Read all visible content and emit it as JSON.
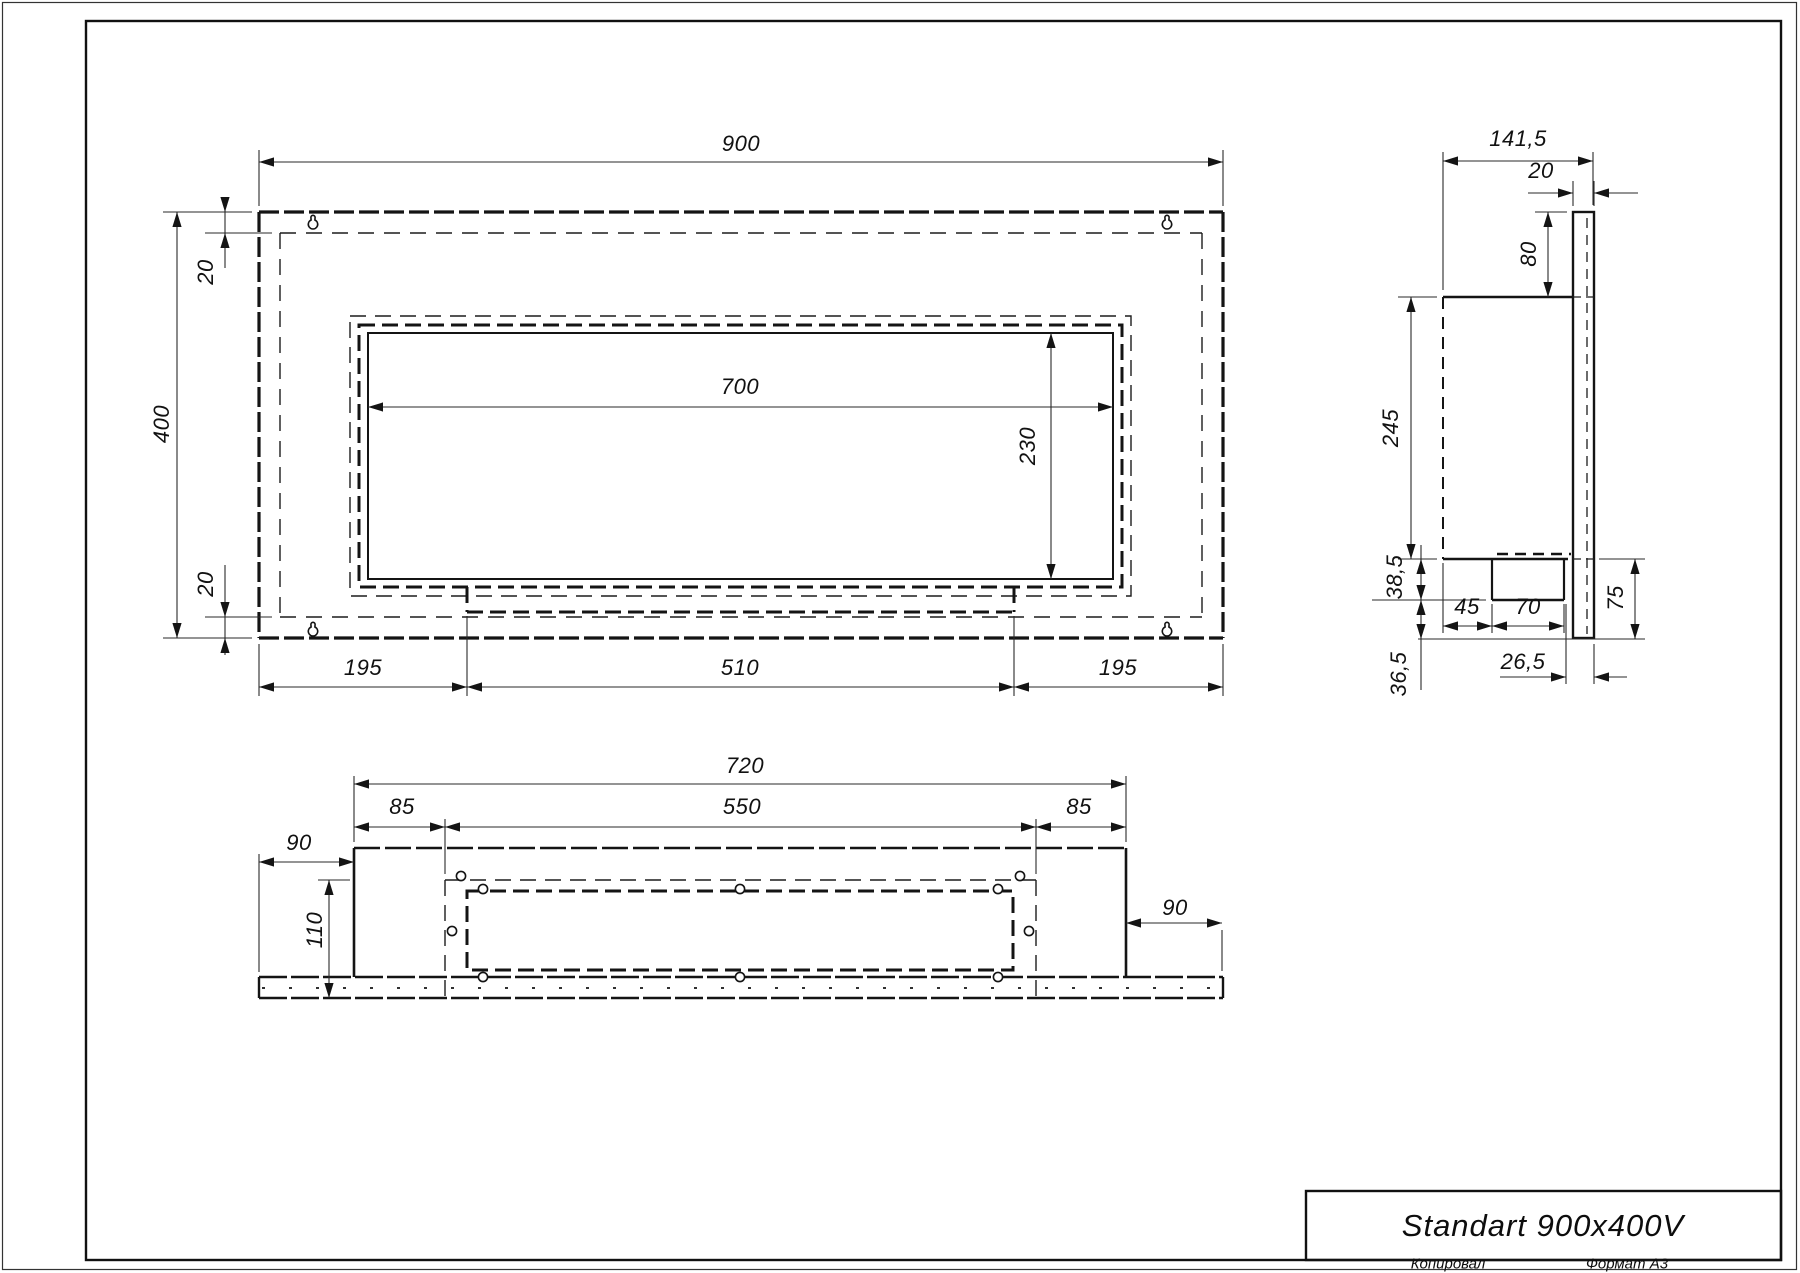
{
  "sheet": {
    "copied_label": "Копировал",
    "format_label": "Формат А3"
  },
  "title_block": {
    "product_name": "Standart 900x400V"
  },
  "views": {
    "front": {
      "dims": {
        "width": "900",
        "height": "400",
        "offset_top": "20",
        "offset_bottom": "20",
        "opening_width": "700",
        "opening_height": "230",
        "bottom_left": "195",
        "bottom_center": "510",
        "bottom_right": "195"
      }
    },
    "side": {
      "dims": {
        "depth": "141,5",
        "plate_thickness": "20",
        "top_drop": "80",
        "body_height": "245",
        "burner_depth": "38,5",
        "bottom_drop": "36,5",
        "front_offset": "45",
        "burner_width": "70",
        "plate_below": "75",
        "back_offset": "26,5"
      }
    },
    "bottom": {
      "dims": {
        "body_width": "720",
        "opening_width": "550",
        "inset_left": "85",
        "inset_right": "85",
        "flange_left": "90",
        "depth": "110",
        "flange_right": "90"
      }
    }
  }
}
